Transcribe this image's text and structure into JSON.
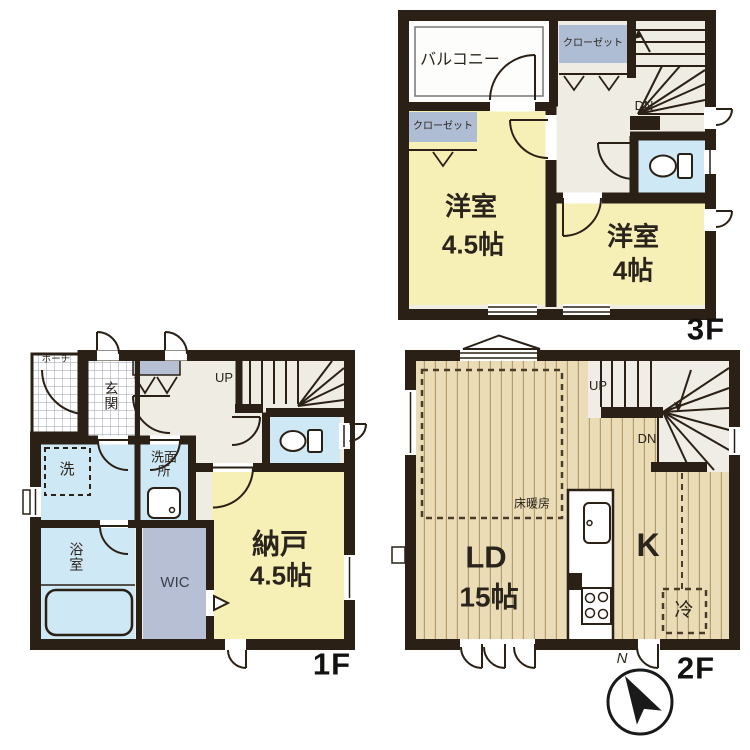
{
  "floors": {
    "f1": {
      "label": "1F",
      "porch": "ポーチ",
      "entrance": "玄関",
      "up": "UP",
      "laundry": "洗",
      "washroom": "洗面所",
      "bath": "浴室",
      "wic": "WIC",
      "storage_name": "納戸",
      "storage_size": "4.5帖"
    },
    "f2": {
      "label": "2F",
      "up": "UP",
      "dn": "DN",
      "floor_heating": "床暖房",
      "ld_name": "LD",
      "ld_size": "15帖",
      "kitchen": "K",
      "fridge": "冷",
      "north": "N"
    },
    "f3": {
      "label": "3F",
      "balcony": "バルコニー",
      "closet_a": "クローゼット",
      "closet_b": "クローゼット",
      "dn": "DN",
      "room_a_name": "洋室",
      "room_a_size": "4.5帖",
      "room_b_name": "洋室",
      "room_b_size": "4帖"
    },
    "colors": {
      "wall": "#2a2016",
      "room_yellow": "#f7f0b6",
      "room_blue": "#cfe8f6",
      "closet_blue": "#aebdd3",
      "wic_gray": "#b6bfd3",
      "hall_cream": "#efece4",
      "wood_tan": "#ebdcb8"
    }
  }
}
